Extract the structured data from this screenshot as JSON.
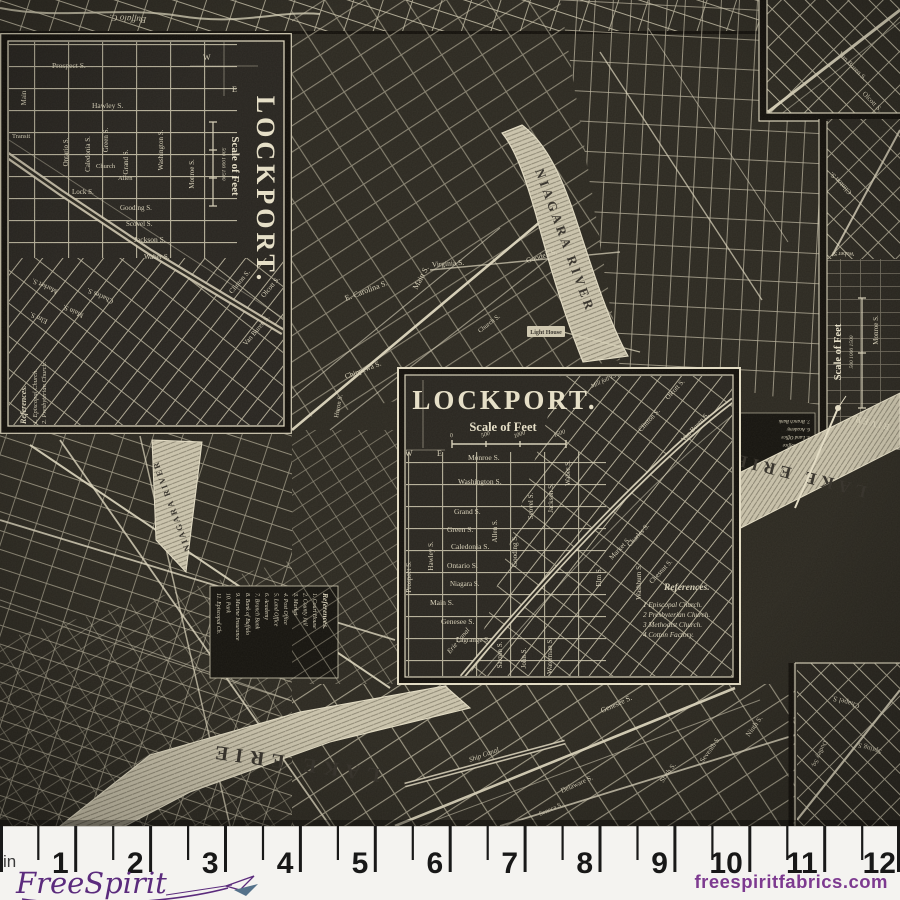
{
  "fabric": {
    "panel_left": {
      "title": "LOCKPORT.",
      "scale_label": "Scale of Feet",
      "scale_ticks": "500  1000  1500",
      "compass_w": "W",
      "compass_e": "E",
      "streets": [
        "Prospect S.",
        "Hawley S.",
        "Main",
        "Transit",
        "Ontario S.",
        "Caledonia S.",
        "Green S.",
        "Church",
        "Grand S.",
        "Allen",
        "Washington S.",
        "Lock S.",
        "Monroe S.",
        "Gooding S.",
        "Scovel S.",
        "Jackson S.",
        "Waber S.",
        "Clinton S.",
        "Olcott S.",
        "Van Buren S.",
        "Charles S.",
        "Main S.",
        "Market S.",
        "Elm S."
      ],
      "references": {
        "heading": "References.",
        "items": [
          "1. Episcopal Church.",
          "2. Presbyterian Church."
        ]
      }
    },
    "panel_center": {
      "title": "LOCKPORT.",
      "scale_label": "Scale of Feet",
      "scale_ticks": [
        "0",
        "500",
        "1000",
        "1500"
      ],
      "compass_w": "W",
      "compass_e": "E",
      "mill_note": "Mill fall 15 ft",
      "canal_label": "Erie Canal",
      "streets_h": [
        "Monroe S.",
        "Washington S.",
        "Grand S.",
        "Green S.",
        "Caledonia S.",
        "Ontario S.",
        "Niagara S.",
        "Main S.",
        "Genesee S.",
        "Lagrange S."
      ],
      "streets_v": [
        "Prospect S.",
        "Hawley S.",
        "Allen S.",
        "Gooding S.",
        "Scovel S.",
        "Jackson S.",
        "Waber S.",
        "Saxton S.",
        "John S.",
        "Waterman S.",
        "Elm S.",
        "Washburn S."
      ],
      "streets_d": [
        "Clinton S.",
        "Olcott S.",
        "Van Buren S.",
        "Market S.",
        "Chesnut S.",
        "Charles S."
      ],
      "references": {
        "heading": "References.",
        "items": [
          "1 Episcopal Church.",
          "2 Presbyterian Church.",
          "3 Methodist Church.",
          "4 Cotton Factory."
        ]
      }
    },
    "background": {
      "top_label": "Buffalo C.",
      "niagara_river": "NIAGARA RIVER",
      "lake_erie": "LAKE ERIE",
      "river_label": "RIVER",
      "light_house": "Light House",
      "ship_canal": "Ship Canal",
      "scale_right": "Scale of Feet",
      "scale_right_ticks": "500  1000  1500",
      "streets": [
        "Virginia S.",
        "E. Carolina S.",
        "Main S.",
        "Goodell S.",
        "Chippewa S.",
        "Huron S.",
        "Church S.",
        "Genesee S.",
        "Sixth S.",
        "Seventh S.",
        "Ninth S.",
        "Delaware S.",
        "Seneca S.",
        "Van Buren S.",
        "Olcott S.",
        "Clinton S.",
        "Waber S.",
        "Monroe S.",
        "Chapel S.",
        "Spring S.",
        "Dudley Sq."
      ],
      "references_buffalo": {
        "heading": "References.",
        "items": [
          "1. Court House",
          "2. County Jail",
          "3. Market",
          "4. Post Office",
          "5. Land Office",
          "6. Academy",
          "7. Branch Bank",
          "8. Bank of Buffalo",
          "9. Marine Insurance",
          "10. Park",
          "11. Episcopal Ch."
        ]
      }
    }
  },
  "ruler": {
    "unit_label": "in",
    "numbers": [
      "1",
      "2",
      "3",
      "4",
      "5",
      "6",
      "7",
      "8",
      "9",
      "10",
      "11",
      "12"
    ]
  },
  "footer": {
    "logo_text": "FreeSpirit",
    "website": "freespiritfabrics.com"
  },
  "colors": {
    "fabric_bg": "#2c2921",
    "map_line": "#d6cfb7",
    "water": "#c9c2ab",
    "ruler_bg": "#f4f3f0",
    "logo_purple": "#5b2b7d",
    "web_purple": "#7d3a90"
  }
}
